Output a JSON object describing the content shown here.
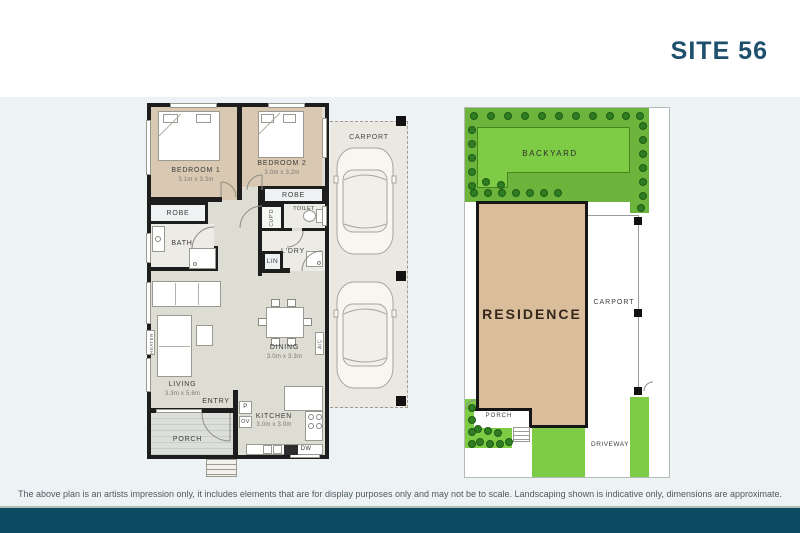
{
  "header": {
    "title": "SITE 56"
  },
  "floorplan": {
    "bedroom1": {
      "name": "BEDROOM 1",
      "dims": "3.1m x 3.3m"
    },
    "bedroom2": {
      "name": "BEDROOM 2",
      "dims": "3.0m x 3.2m"
    },
    "living": {
      "name": "LIVING",
      "dims": "3.3m x 5.6m"
    },
    "dining": {
      "name": "DINING",
      "dims": "3.0m x 3.3m"
    },
    "kitchen": {
      "name": "KITCHEN",
      "dims": "3.0m x 3.0m"
    },
    "robe1": "ROBE",
    "robe2": "ROBE",
    "bath": "BATH",
    "cupd": "CUP'D",
    "toilet": "TOILET",
    "ldry": "L'DRY",
    "lin": "LIN",
    "heater": "HEATER",
    "ac": "A/C",
    "entry": "ENTRY",
    "porch": "PORCH",
    "carport": "CARPORT",
    "pantry": "P",
    "oven": "OV",
    "dishwasher": "DW"
  },
  "siteplan": {
    "backyard": "BACKYARD",
    "residence": "RESIDENCE",
    "carport": "CARPORT",
    "porch": "PORCH",
    "driveway": "DRIVEWAY"
  },
  "footer": {
    "disclaimer": "The above plan is an artists impression only, it includes elements that are for display purposes only and may not be to scale. Landscaping shown is indicative only, dimensions are approximate."
  },
  "colors": {
    "footer_navy": "#0c4a64",
    "title_teal": "#1e506e",
    "page_bg": "#edf2f4",
    "grass": "#7ecb45",
    "grass_dark": "#6cb43c",
    "shrub_green": "#2f7d22",
    "residence_tan": "#dabd9a",
    "bedroom_floor_tan": "#d9c9b2",
    "interior_floor": "#deddd3",
    "wall_black": "#1d1d1d"
  }
}
